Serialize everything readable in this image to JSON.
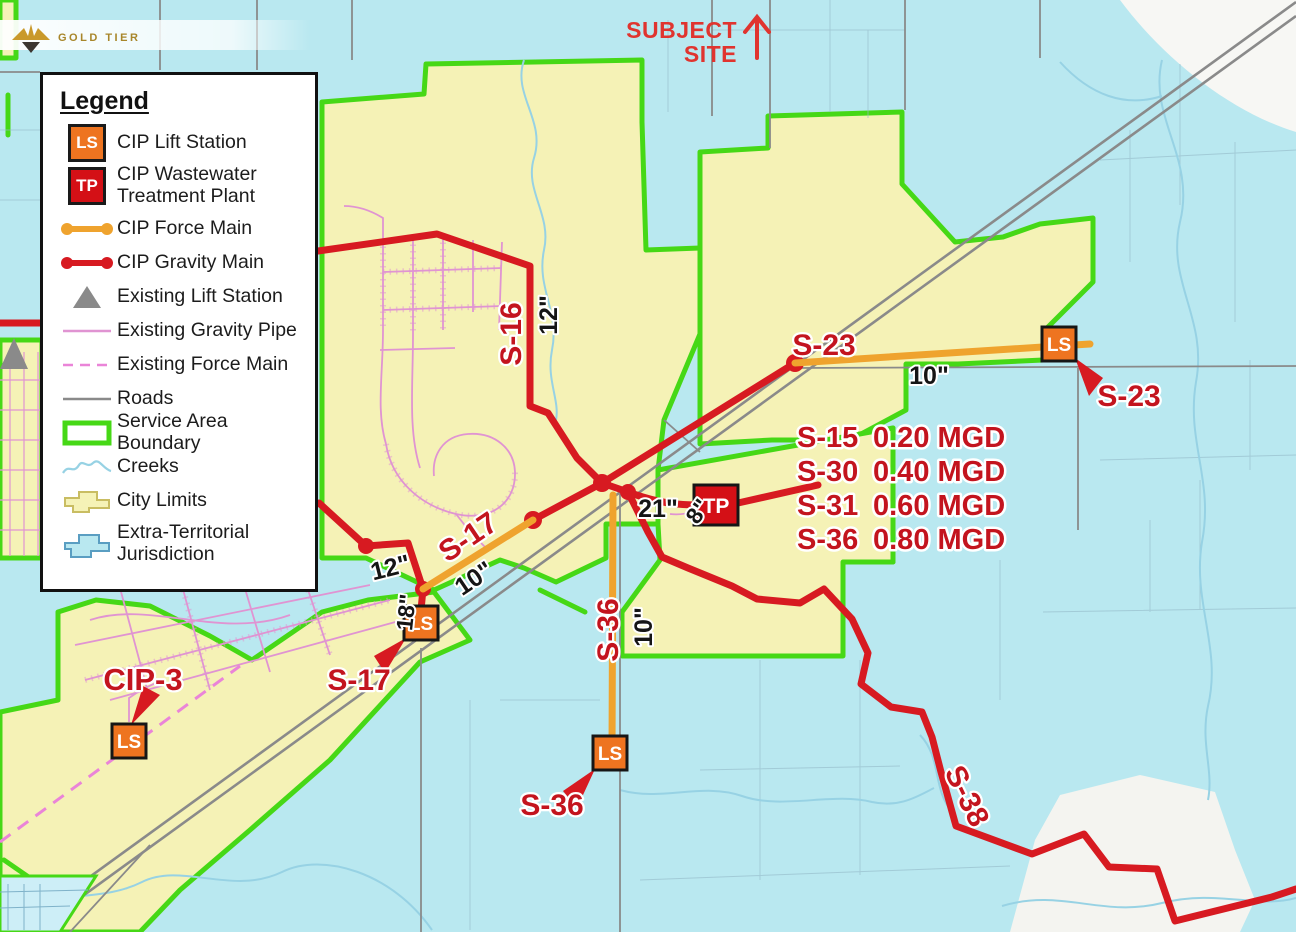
{
  "watermark": {
    "brand": "GOLD TIER"
  },
  "subject_site": {
    "line1": "SUBJECT",
    "line2": "SITE"
  },
  "legend": {
    "title": "Legend",
    "items": [
      {
        "label": "CIP Lift Station"
      },
      {
        "label": "CIP Wastewater Treatment Plant"
      },
      {
        "label": "CIP Force Main"
      },
      {
        "label": "CIP Gravity Main"
      },
      {
        "label": "Existing Lift Station"
      },
      {
        "label": "Existing Gravity Pipe"
      },
      {
        "label": "Existing Force Main"
      },
      {
        "label": "Roads"
      },
      {
        "label": "Service Area Boundary"
      },
      {
        "label": "Creeks"
      },
      {
        "label": "City Limits"
      },
      {
        "label": "Extra-Territorial Jurisdiction"
      }
    ]
  },
  "markers": {
    "lift_station": "LS",
    "treatment_plant": "TP"
  },
  "flow_table": {
    "rows": [
      {
        "id": "S-15",
        "flow": "0.20 MGD"
      },
      {
        "id": "S-30",
        "flow": "0.40 MGD"
      },
      {
        "id": "S-31",
        "flow": "0.60 MGD"
      },
      {
        "id": "S-36",
        "flow": "0.80 MGD"
      }
    ]
  },
  "map_labels": {
    "s16": "S-16",
    "s16_pipe": "12\"",
    "s23": "S-23",
    "s23_pipe": "10\"",
    "s23_station": "S-23",
    "s17": "S-17",
    "s17_pipe": "10\"",
    "s17_pipe_12": "12\"",
    "s17_pipe_18": "18\"",
    "s17_station": "S-17",
    "s36": "S-36",
    "s36_pipe": "10\"",
    "s36_station": "S-36",
    "s38": "S-38",
    "cip3": "CIP-3",
    "tp_pipe_21": "21\"",
    "tp_pipe_8": "8\""
  },
  "colors": {
    "cip_gravity_main": "#d71a21",
    "cip_force_main": "#efa32e",
    "service_area_boundary": "#46d816",
    "city_limits": "#f5f2b6",
    "etj": "#b9e8f0",
    "existing_pipe_pink": "#e094d2",
    "roads_gray": "#8a8a8a",
    "label_red": "#c3141e",
    "subject_red": "#e0342f",
    "ls_orange": "#ee7420",
    "tp_red": "#d41016"
  }
}
